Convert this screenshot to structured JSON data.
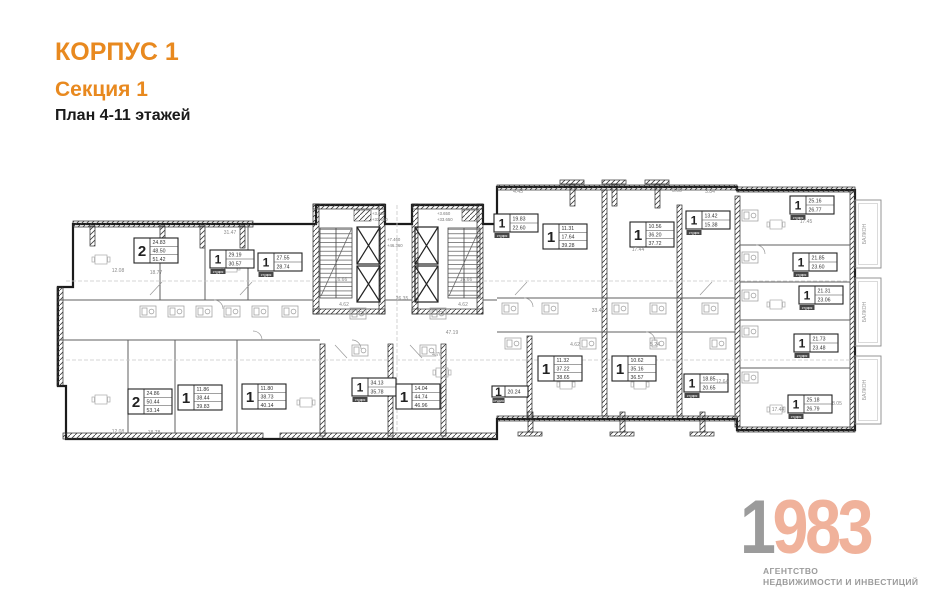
{
  "header": {
    "building": "КОРПУС 1",
    "section": "Секция 1",
    "plan_title": "План 4-11 этажей"
  },
  "logo": {
    "year_gray": "1",
    "year_accent": "983",
    "agency_line1": "АГЕНТСТВО",
    "agency_line2": "НЕДВИЖИМОСТИ И ИНВЕСТИЦИЙ"
  },
  "colors": {
    "accent_orange": "#e8891f",
    "logo_gray": "#9b9b9b",
    "logo_salmon": "#f0b29b",
    "wall_black": "#1b1b1b"
  },
  "plan": {
    "studio_label": "студия",
    "balcony_label": "БАЛКОН",
    "balconies": [
      {
        "y": 200
      },
      {
        "y": 278
      },
      {
        "y": 356
      }
    ],
    "apartments": [
      {
        "type": "2",
        "areas": [
          "24.83",
          "48.50",
          "51.42"
        ],
        "x": 134,
        "y": 238
      },
      {
        "type": "1",
        "areas": [
          "29.19",
          "30.57"
        ],
        "x": 210,
        "y": 250,
        "studio": true
      },
      {
        "type": "1",
        "areas": [
          "27.55",
          "28.74"
        ],
        "x": 258,
        "y": 253,
        "studio": true
      },
      {
        "type": "1",
        "areas": [
          "19.83",
          "22.60"
        ],
        "x": 494,
        "y": 214,
        "studio": true
      },
      {
        "type": "1",
        "areas": [
          "11.31",
          "17.64",
          "39.28"
        ],
        "x": 543,
        "y": 224
      },
      {
        "type": "1",
        "areas": [
          "10.56",
          "36.20",
          "37.72"
        ],
        "x": 630,
        "y": 222
      },
      {
        "type": "1",
        "areas": [
          "13.42",
          "15.38"
        ],
        "x": 686,
        "y": 211,
        "studio": true
      },
      {
        "type": "1",
        "areas": [
          "25.16",
          "26.77"
        ],
        "x": 790,
        "y": 196,
        "studio": true
      },
      {
        "type": "1",
        "areas": [
          "21.85",
          "23.60"
        ],
        "x": 793,
        "y": 253,
        "studio": true
      },
      {
        "type": "1",
        "areas": [
          "21.31",
          "23.06"
        ],
        "x": 799,
        "y": 286,
        "studio": true
      },
      {
        "type": "1",
        "areas": [
          "21.73",
          "23.48"
        ],
        "x": 794,
        "y": 334,
        "studio": true
      },
      {
        "type": "1",
        "areas": [
          "25.18",
          "26.79"
        ],
        "x": 788,
        "y": 395,
        "studio": true
      },
      {
        "type": "2",
        "areas": [
          "24.86",
          "50.44",
          "53.14"
        ],
        "x": 128,
        "y": 389
      },
      {
        "type": "1",
        "areas": [
          "11.86",
          "38.44",
          "39.83"
        ],
        "x": 178,
        "y": 385
      },
      {
        "type": "1",
        "areas": [
          "11.80",
          "38.73",
          "40.14"
        ],
        "x": 242,
        "y": 384
      },
      {
        "type": "1",
        "areas": [
          "34.13",
          "35.78"
        ],
        "x": 352,
        "y": 378,
        "studio": true
      },
      {
        "type": "1",
        "areas": [
          "14.04",
          "44.74",
          "46.96"
        ],
        "x": 396,
        "y": 384
      },
      {
        "type": "1",
        "areas": [
          "20.24"
        ],
        "x": 492,
        "y": 386,
        "studio": true
      },
      {
        "type": "1",
        "areas": [
          "11.32",
          "37.22",
          "38.65"
        ],
        "x": 538,
        "y": 356
      },
      {
        "type": "1",
        "areas": [
          "10.62",
          "35.16",
          "36.57"
        ],
        "x": 612,
        "y": 356
      },
      {
        "type": "1",
        "areas": [
          "18.85",
          "20.65"
        ],
        "x": 684,
        "y": 374,
        "studio": true
      }
    ],
    "dimensions": [
      {
        "t": "12.08",
        "x": 118,
        "y": 272
      },
      {
        "t": "18.77",
        "x": 156,
        "y": 274
      },
      {
        "t": "31.47",
        "x": 230,
        "y": 234
      },
      {
        "t": "16.66",
        "x": 341,
        "y": 281
      },
      {
        "t": "16.66",
        "x": 466,
        "y": 281
      },
      {
        "t": "26.35",
        "x": 402,
        "y": 300
      },
      {
        "t": "4.62",
        "x": 344,
        "y": 306
      },
      {
        "t": "4.62",
        "x": 463,
        "y": 306
      },
      {
        "t": "47.19",
        "x": 452,
        "y": 334
      },
      {
        "t": "33.47",
        "x": 598,
        "y": 312
      },
      {
        "t": "17.44",
        "x": 638,
        "y": 251
      },
      {
        "t": "17.45",
        "x": 806,
        "y": 223
      },
      {
        "t": "12.64",
        "x": 722,
        "y": 383
      },
      {
        "t": "17.44",
        "x": 778,
        "y": 411
      },
      {
        "t": "12.08",
        "x": 118,
        "y": 433
      },
      {
        "t": "18.78",
        "x": 154,
        "y": 434
      },
      {
        "t": "4.70",
        "x": 437,
        "y": 356
      },
      {
        "t": "4.62",
        "x": 575,
        "y": 346
      },
      {
        "t": "5.24",
        "x": 655,
        "y": 346
      },
      {
        "t": "4.45",
        "x": 518,
        "y": 193
      },
      {
        "t": "3.08",
        "x": 677,
        "y": 192
      },
      {
        "t": "3.84",
        "x": 710,
        "y": 193
      },
      {
        "t": "8.05",
        "x": 837,
        "y": 405
      }
    ],
    "levels": [
      {
        "t": "+3.650",
        "x": 372,
        "y": 215
      },
      {
        "t": "+33.650",
        "x": 372,
        "y": 221
      },
      {
        "t": "+3.650",
        "x": 437,
        "y": 215
      },
      {
        "t": "+33.650",
        "x": 437,
        "y": 221
      },
      {
        "t": "+7.460",
        "x": 387,
        "y": 241
      },
      {
        "t": "+46.360",
        "x": 387,
        "y": 247
      }
    ]
  }
}
